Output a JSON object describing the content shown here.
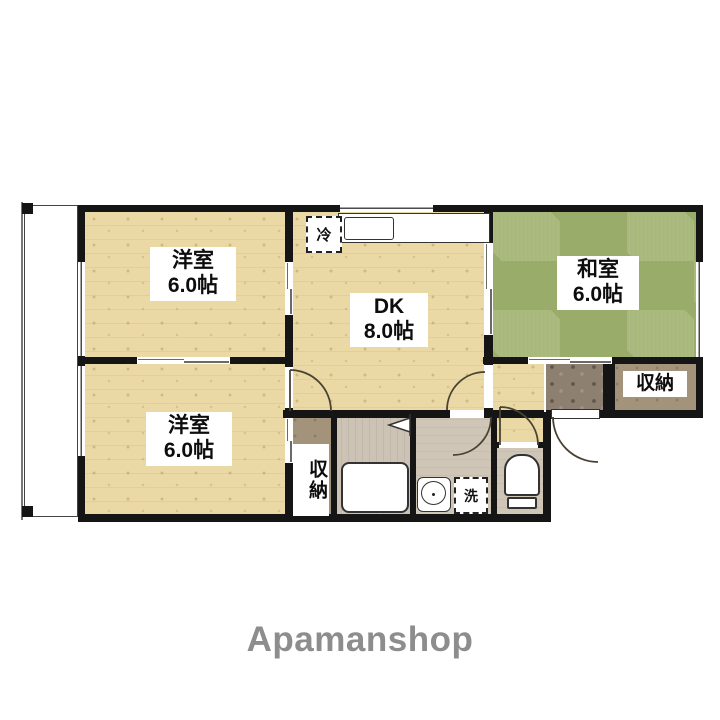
{
  "branding": {
    "watermark": "Apamanshop"
  },
  "plan": {
    "room_west_top": {
      "name": "洋室",
      "size": "6.0帖"
    },
    "dining_kitchen": {
      "name": "DK",
      "size": "8.0帖"
    },
    "japanese_room": {
      "name": "和室",
      "size": "6.0帖"
    },
    "room_west_bottom": {
      "name": "洋室",
      "size": "6.0帖"
    },
    "closet_middle": {
      "name": "収納"
    },
    "closet_entrance": {
      "name": "収納"
    },
    "refrigerator": {
      "name": "冷"
    },
    "washer": {
      "name": "洗"
    }
  },
  "colors": {
    "wood_floor": "#ead9a4",
    "tatami_light": "#a9b87c",
    "tatami_dark": "#9aac69",
    "closet_floor": "#a3937a",
    "genkan_floor": "#8d8071",
    "wet_floor": "#cfc6b8",
    "wall": "#151515",
    "watermark_text": "#8d8d8d"
  }
}
